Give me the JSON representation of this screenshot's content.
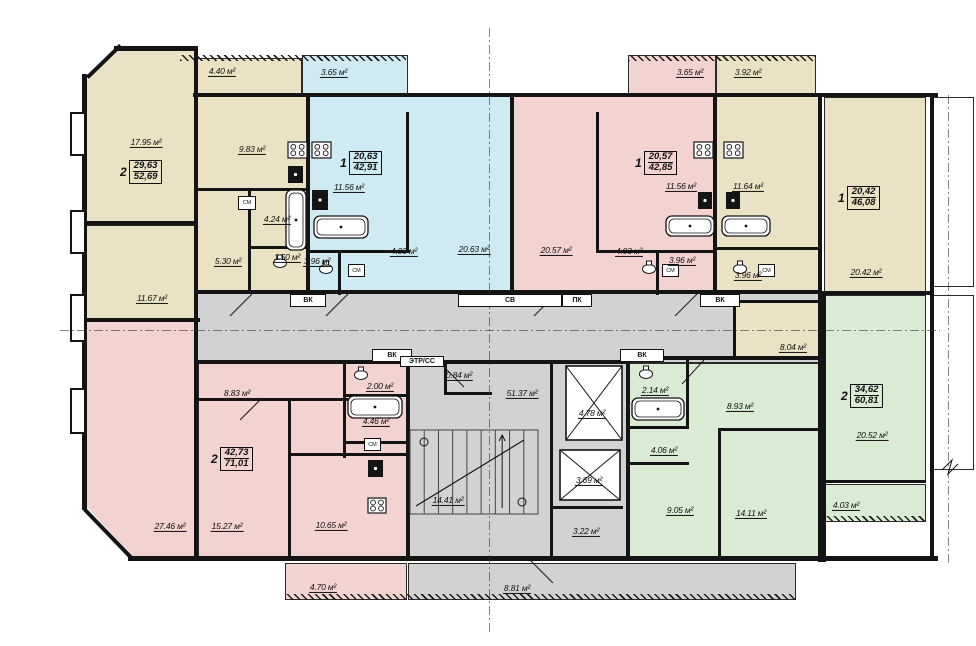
{
  "colors": {
    "beige": "#ebe2c5",
    "blue": "#cfeaf2",
    "pink": "#f2d3d0",
    "green": "#d9ebd2",
    "gray": "#d2d2d2",
    "white": "#ffffff",
    "wall": "#141414"
  },
  "plan": {
    "regions": [
      [
        178,
        58,
        124,
        37,
        "beige",
        "balcony"
      ],
      [
        302,
        55,
        106,
        40,
        "blue",
        "balcony"
      ],
      [
        628,
        55,
        88,
        40,
        "pink",
        "balcony"
      ],
      [
        716,
        55,
        100,
        40,
        "beige",
        "balcony"
      ],
      [
        86,
        50,
        110,
        173,
        "beige",
        "room-living",
        "clip-tl"
      ],
      [
        86,
        225,
        110,
        95,
        "beige",
        "room"
      ],
      [
        196,
        95,
        112,
        198,
        "beige",
        "kitchen-zone"
      ],
      [
        308,
        95,
        204,
        198,
        "blue",
        "apartment-1k-blue"
      ],
      [
        512,
        95,
        203,
        198,
        "pink",
        "apartment-1k-pink"
      ],
      [
        715,
        95,
        105,
        198,
        "beige",
        "kitchen-zone"
      ],
      [
        824,
        97,
        102,
        196,
        "beige",
        "room-living"
      ],
      [
        196,
        293,
        624,
        70,
        "gray",
        "corridor"
      ],
      [
        735,
        302,
        85,
        58,
        "beige",
        "room"
      ],
      [
        86,
        320,
        112,
        238,
        "pink",
        "room-living",
        "clip-bl"
      ],
      [
        198,
        363,
        210,
        195,
        "pink",
        "apartment-2k-rooms"
      ],
      [
        408,
        363,
        220,
        195,
        "gray",
        "stair-core"
      ],
      [
        628,
        363,
        194,
        195,
        "green",
        "apartment-2k-green"
      ],
      [
        824,
        295,
        102,
        187,
        "green",
        "room-living"
      ],
      [
        824,
        484,
        102,
        38,
        "green",
        "balcony"
      ],
      [
        285,
        563,
        122,
        37,
        "pink",
        "balcony"
      ],
      [
        408,
        563,
        388,
        37,
        "gray",
        "balcony"
      ],
      [
        932,
        97,
        42,
        190,
        "white",
        "adjacent-room"
      ],
      [
        932,
        295,
        42,
        175,
        "white",
        "adjacent-room"
      ]
    ],
    "hatches": [
      [
        180,
        55,
        226,
        6
      ],
      [
        628,
        55,
        188,
        6
      ],
      [
        285,
        594,
        511,
        6
      ],
      [
        824,
        516,
        102,
        5
      ]
    ],
    "walls": [
      [
        114,
        46,
        84,
        5
      ],
      [
        82,
        74,
        5,
        436
      ],
      [
        128,
        556,
        810,
        5
      ],
      [
        193,
        93,
        745,
        4
      ],
      [
        930,
        93,
        4,
        467
      ],
      [
        194,
        46,
        4,
        514
      ],
      [
        306,
        93,
        4,
        202
      ],
      [
        510,
        93,
        4,
        202
      ],
      [
        713,
        93,
        4,
        202
      ],
      [
        818,
        93,
        4,
        469
      ],
      [
        822,
        293,
        4,
        269
      ],
      [
        406,
        360,
        4,
        200
      ],
      [
        626,
        356,
        4,
        204
      ],
      [
        550,
        363,
        3,
        197
      ],
      [
        86,
        221,
        112,
        4
      ],
      [
        86,
        318,
        114,
        4
      ],
      [
        196,
        188,
        112,
        3
      ],
      [
        248,
        188,
        3,
        105
      ],
      [
        248,
        246,
        60,
        3
      ],
      [
        196,
        290,
        626,
        4
      ],
      [
        196,
        360,
        434,
        4
      ],
      [
        630,
        356,
        192,
        4
      ],
      [
        733,
        300,
        3,
        60
      ],
      [
        733,
        300,
        87,
        3
      ],
      [
        822,
        291,
        112,
        4
      ],
      [
        824,
        480,
        102,
        3
      ],
      [
        406,
        112,
        3,
        140
      ],
      [
        308,
        250,
        102,
        3
      ],
      [
        338,
        250,
        3,
        45
      ],
      [
        596,
        112,
        3,
        140
      ],
      [
        596,
        250,
        121,
        3
      ],
      [
        656,
        250,
        3,
        45
      ],
      [
        715,
        247,
        105,
        3
      ],
      [
        198,
        398,
        150,
        3
      ],
      [
        288,
        398,
        3,
        160
      ],
      [
        290,
        453,
        120,
        3
      ],
      [
        343,
        360,
        3,
        98
      ],
      [
        343,
        394,
        67,
        3
      ],
      [
        343,
        441,
        67,
        3
      ],
      [
        686,
        360,
        3,
        68
      ],
      [
        628,
        426,
        61,
        3
      ],
      [
        628,
        462,
        61,
        3
      ],
      [
        718,
        428,
        3,
        130
      ],
      [
        718,
        428,
        104,
        3
      ],
      [
        444,
        392,
        48,
        3
      ],
      [
        444,
        363,
        3,
        32
      ],
      [
        551,
        506,
        72,
        3
      ]
    ],
    "dwalls": [
      {
        "x": 86,
        "y": 76,
        "len": 46,
        "ang": -44
      },
      {
        "x": 86,
        "y": 508,
        "len": 68,
        "ang": 46
      }
    ],
    "bumps": [
      [
        70,
        112,
        16,
        44
      ],
      [
        70,
        210,
        16,
        44
      ],
      [
        70,
        294,
        16,
        48
      ],
      [
        70,
        388,
        16,
        46
      ]
    ],
    "dashdots": [
      {
        "o": "h",
        "x": 60,
        "y": 330,
        "len": 880
      },
      {
        "o": "v",
        "x": 489,
        "y": 28,
        "len": 604
      },
      {
        "o": "v",
        "x": 948,
        "y": 95,
        "len": 470
      }
    ],
    "labels": [
      {
        "t": "4.40 м²",
        "x": 222,
        "y": 72
      },
      {
        "t": "3.65 м²",
        "x": 334,
        "y": 73
      },
      {
        "t": "3.65 м²",
        "x": 690,
        "y": 73
      },
      {
        "t": "3.92 м²",
        "x": 748,
        "y": 73
      },
      {
        "t": "17.95 м²",
        "x": 146,
        "y": 143
      },
      {
        "t": "9.83 м²",
        "x": 252,
        "y": 150
      },
      {
        "t": "11.67 м²",
        "x": 152,
        "y": 299
      },
      {
        "t": "5.30 м²",
        "x": 228,
        "y": 262
      },
      {
        "t": "4.24 м²",
        "x": 277,
        "y": 220
      },
      {
        "t": "1.50 м²",
        "x": 287,
        "y": 258
      },
      {
        "t": "11.56 м²",
        "x": 349,
        "y": 188
      },
      {
        "t": "20.63 м²",
        "x": 474,
        "y": 250
      },
      {
        "t": "4.93 м²",
        "x": 404,
        "y": 252
      },
      {
        "t": "3.96 м²",
        "x": 317,
        "y": 262
      },
      {
        "t": "20.57 м²",
        "x": 556,
        "y": 251
      },
      {
        "t": "11.56 м²",
        "x": 681,
        "y": 187
      },
      {
        "t": "11.64 м²",
        "x": 748,
        "y": 187
      },
      {
        "t": "4.93 м²",
        "x": 629,
        "y": 252
      },
      {
        "t": "3.96 м²",
        "x": 682,
        "y": 261
      },
      {
        "t": "3.96 м²",
        "x": 748,
        "y": 276
      },
      {
        "t": "20.42 м²",
        "x": 866,
        "y": 273
      },
      {
        "t": "8.04 м²",
        "x": 793,
        "y": 348
      },
      {
        "t": "27.46 м²",
        "x": 170,
        "y": 527
      },
      {
        "t": "15.27 м²",
        "x": 227,
        "y": 527
      },
      {
        "t": "8.83 м²",
        "x": 237,
        "y": 394
      },
      {
        "t": "2.00 м²",
        "x": 380,
        "y": 387
      },
      {
        "t": "4.46 м²",
        "x": 376,
        "y": 422
      },
      {
        "t": "10.65 м²",
        "x": 331,
        "y": 526
      },
      {
        "t": "4.70 м²",
        "x": 323,
        "y": 588
      },
      {
        "t": "51.37 м²",
        "x": 522,
        "y": 394
      },
      {
        "t": "0.84 м²",
        "x": 459,
        "y": 376
      },
      {
        "t": "14.41 м²",
        "x": 448,
        "y": 501
      },
      {
        "t": "4.78 м²",
        "x": 592,
        "y": 414
      },
      {
        "t": "3.69 м²",
        "x": 589,
        "y": 481
      },
      {
        "t": "3.22 м²",
        "x": 586,
        "y": 532
      },
      {
        "t": "8.81 м²",
        "x": 517,
        "y": 589
      },
      {
        "t": "2.14 м²",
        "x": 655,
        "y": 391
      },
      {
        "t": "8.93 м²",
        "x": 740,
        "y": 407
      },
      {
        "t": "4.06 м²",
        "x": 664,
        "y": 451
      },
      {
        "t": "9.05 м²",
        "x": 680,
        "y": 511
      },
      {
        "t": "14.11 м²",
        "x": 751,
        "y": 514
      },
      {
        "t": "20.52 м²",
        "x": 872,
        "y": 436
      },
      {
        "t": "4.03 м²",
        "x": 846,
        "y": 506
      }
    ],
    "badges": [
      {
        "x": 120,
        "y": 160,
        "num": "2",
        "top": "29,63",
        "bot": "52,69"
      },
      {
        "x": 340,
        "y": 151,
        "num": "1",
        "top": "20,63",
        "bot": "42,91"
      },
      {
        "x": 635,
        "y": 151,
        "num": "1",
        "top": "20,57",
        "bot": "42,85"
      },
      {
        "x": 838,
        "y": 186,
        "num": "1",
        "top": "20,42",
        "bot": "46,08"
      },
      {
        "x": 211,
        "y": 447,
        "num": "2",
        "top": "42,73",
        "bot": "71,01"
      },
      {
        "x": 841,
        "y": 384,
        "num": "2",
        "top": "34,62",
        "bot": "60,81"
      }
    ],
    "tags": [
      {
        "t": "ВК",
        "x": 290,
        "y": 294,
        "w": 36,
        "h": 13
      },
      {
        "t": "СВ",
        "x": 458,
        "y": 294,
        "w": 104,
        "h": 13
      },
      {
        "t": "ПК",
        "x": 562,
        "y": 294,
        "w": 30,
        "h": 13
      },
      {
        "t": "ВК",
        "x": 700,
        "y": 294,
        "w": 40,
        "h": 13
      },
      {
        "t": "ВК",
        "x": 372,
        "y": 349,
        "w": 40,
        "h": 13
      },
      {
        "t": "ВК",
        "x": 620,
        "y": 349,
        "w": 44,
        "h": 13
      },
      {
        "t": "ЭТР/СС",
        "x": 400,
        "y": 356,
        "w": 44,
        "h": 11
      }
    ],
    "sm_tags": [
      {
        "t": "СМ",
        "x": 238,
        "y": 196,
        "w": 18,
        "h": 14
      },
      {
        "t": "СМ",
        "x": 348,
        "y": 264,
        "w": 17,
        "h": 13
      },
      {
        "t": "СМ",
        "x": 662,
        "y": 264,
        "w": 17,
        "h": 13
      },
      {
        "t": "СМ",
        "x": 758,
        "y": 264,
        "w": 17,
        "h": 13
      },
      {
        "t": "СМ",
        "x": 364,
        "y": 438,
        "w": 17,
        "h": 13
      }
    ],
    "tubs": [
      [
        286,
        190,
        20,
        60
      ],
      [
        314,
        216,
        54,
        22
      ],
      [
        666,
        216,
        48,
        20
      ],
      [
        722,
        216,
        48,
        20
      ],
      [
        348,
        396,
        54,
        22
      ],
      [
        632,
        398,
        52,
        22
      ]
    ],
    "stoves": [
      [
        288,
        142,
        19,
        16
      ],
      [
        312,
        142,
        19,
        16
      ],
      [
        694,
        142,
        19,
        16
      ],
      [
        724,
        142,
        19,
        16
      ],
      [
        368,
        498,
        18,
        15
      ]
    ],
    "sinks": [
      [
        288,
        166,
        15,
        17
      ],
      [
        312,
        190,
        16,
        20
      ],
      [
        698,
        192,
        14,
        17
      ],
      [
        726,
        192,
        14,
        17
      ],
      [
        368,
        460,
        15,
        17
      ]
    ],
    "wcs": [
      [
        280,
        263
      ],
      [
        326,
        269
      ],
      [
        649,
        269
      ],
      [
        740,
        269
      ],
      [
        361,
        375
      ],
      [
        646,
        374
      ]
    ],
    "elevators": [
      [
        566,
        366,
        56,
        74
      ],
      [
        560,
        450,
        60,
        50
      ]
    ],
    "stairs": [
      410,
      430,
      128,
      84
    ],
    "doors": [
      [
        252,
        294,
        230,
        316
      ],
      [
        348,
        294,
        326,
        316
      ],
      [
        556,
        294,
        534,
        316
      ],
      [
        697,
        294,
        675,
        316
      ],
      [
        440,
        363,
        464,
        387
      ],
      [
        704,
        360,
        682,
        384
      ],
      [
        530,
        560,
        553,
        583
      ],
      [
        262,
        398,
        240,
        420
      ]
    ],
    "breaks": [
      [
        942,
        470
      ],
      [
        952,
        460
      ],
      [
        948,
        474
      ],
      [
        958,
        464
      ]
    ]
  }
}
